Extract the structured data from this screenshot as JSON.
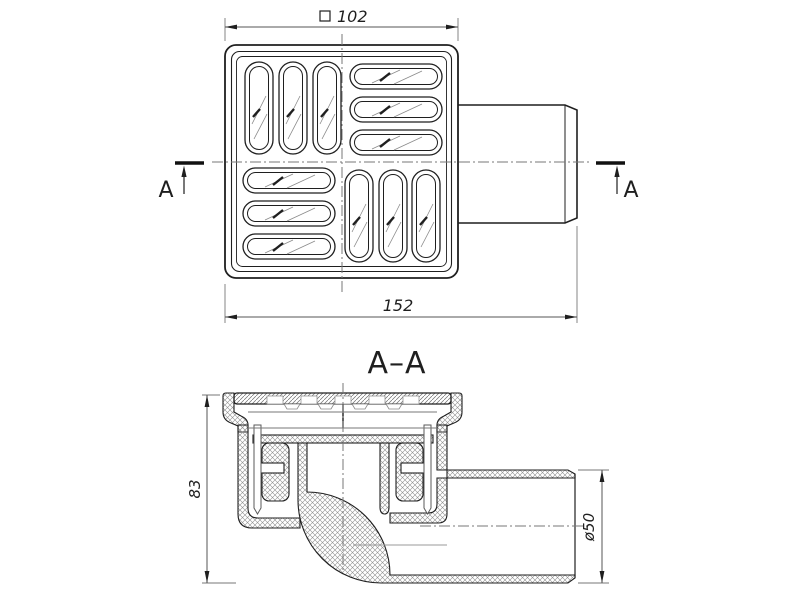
{
  "drawing": {
    "type": "technical-drawing",
    "subject": "floor drain with horizontal outlet, two views",
    "background_color": "#ffffff",
    "line_color": "#1f1f1f",
    "thin_line_color": "#777777",
    "top_view": {
      "dim_grate_width": {
        "symbol": "□",
        "value": "102",
        "display": "□ 102"
      },
      "dim_total_length": {
        "value": "152"
      },
      "section_cut_label_left": "A",
      "section_cut_label_right": "A",
      "grate_slots": {
        "count": 12,
        "pattern": "4 quadrants of 3 oval slots, alternating vertical/horizontal"
      }
    },
    "section_view": {
      "title": "A–A",
      "dim_body_height": {
        "value": "83"
      },
      "dim_outlet_diameter": {
        "symbol": "ø",
        "value": "50",
        "display": "ø50"
      }
    }
  }
}
